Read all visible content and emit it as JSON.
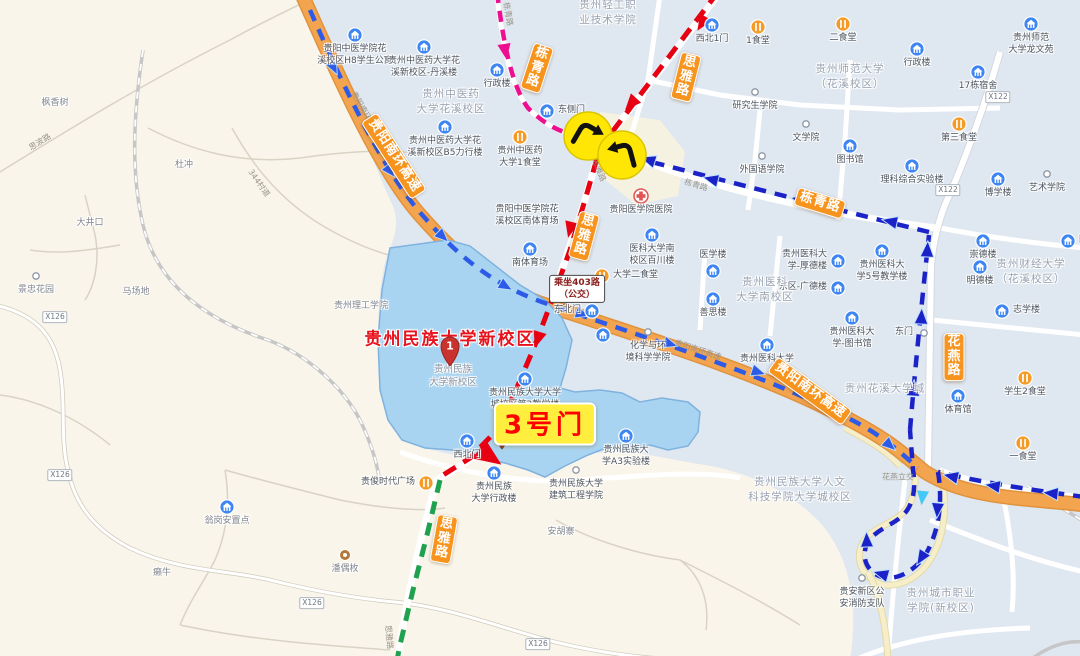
{
  "map": {
    "destination": {
      "name": "贵州民族大学新校区",
      "pin_number": "1",
      "sub_lines": [
        "贵州民族",
        "大学新校区"
      ]
    },
    "gate_callout": "3号门",
    "bus_callout_lines": [
      "乘坐403路",
      "（公交）"
    ],
    "colors": {
      "highway": "#F3A44F",
      "route_red": "#E60012",
      "route_pink": "#ED0F8F",
      "route_blue": "#1B23C8",
      "route_blue_light": "#2D5BE8",
      "route_cyan": "#45C8F5",
      "route_green": "#1FA14F",
      "campus_fill": "#A9D4F1",
      "campus_stroke": "#7FB2DE",
      "urban_fill": "#DFE7F0",
      "rural_fill": "#F9F5EA",
      "ribbon_bg": "#F7941E",
      "turn_icon_bg": "#FFE604"
    }
  },
  "road_ribbons": [
    {
      "n": "ribbon-nanhuan-west",
      "t": "贵阳南环高速",
      "x": 394,
      "y": 156,
      "r": 57,
      "stacked": false
    },
    {
      "n": "ribbon-nanhuan-east",
      "t": "贵阳南环高速",
      "x": 810,
      "y": 391,
      "r": 36,
      "stacked": false
    },
    {
      "n": "ribbon-dongqing-east",
      "t": "栋青路",
      "x": 820,
      "y": 203,
      "r": 17,
      "stacked": false
    },
    {
      "n": "ribbon-dongqing-north",
      "t": "栋青路",
      "x": 537,
      "y": 68,
      "r": 18,
      "stacked": true
    },
    {
      "n": "ribbon-siya-north",
      "t": "思雅路",
      "x": 686,
      "y": 77,
      "r": 14,
      "stacked": true
    },
    {
      "n": "ribbon-siya-mid",
      "t": "思雅路",
      "x": 584,
      "y": 236,
      "r": 15,
      "stacked": true
    },
    {
      "n": "ribbon-siya-south",
      "t": "思雅路",
      "x": 444,
      "y": 539,
      "r": 10,
      "stacked": true
    },
    {
      "n": "ribbon-huayan",
      "t": "花燕路",
      "x": 954,
      "y": 357,
      "r": 0,
      "stacked": true
    }
  ],
  "area_labels": [
    {
      "n": "area-zhongyiyao-campus",
      "x": 451,
      "y": 102,
      "l": [
        "贵州中医药",
        "大学花溪校区"
      ]
    },
    {
      "n": "area-shifan-campus",
      "x": 850,
      "y": 77,
      "l": [
        "贵州师范大学",
        "（花溪校区）"
      ]
    },
    {
      "n": "area-qinggong-college",
      "x": 608,
      "y": 13,
      "l": [
        "贵州轻工职",
        "业技术学院"
      ]
    },
    {
      "n": "area-caijing-campus",
      "x": 1031,
      "y": 272,
      "l": [
        "贵州财经大学",
        "（花溪校区）"
      ]
    },
    {
      "n": "area-yike-south-campus",
      "x": 765,
      "y": 290,
      "l": [
        "贵州医科",
        "大学南校区"
      ]
    },
    {
      "n": "area-huaxi-university-town",
      "x": 885,
      "y": 389,
      "l": [
        "贵州花溪大学城"
      ]
    },
    {
      "n": "area-renwen-keji-campus",
      "x": 800,
      "y": 490,
      "l": [
        "贵州民族大学人文",
        "科技学院大学城校区"
      ]
    },
    {
      "n": "area-city-vocational",
      "x": 941,
      "y": 601,
      "l": [
        "贵州城市职业",
        "学院(新校区)"
      ]
    }
  ],
  "pois": [
    {
      "n": "poi-h8-dorm",
      "i": "b",
      "x": 355,
      "y": 35,
      "l": [
        "贵阳中医学院花",
        "溪校区H8学生公寓"
      ],
      "p": "pb"
    },
    {
      "n": "poi-danxi-building",
      "i": "b",
      "x": 424,
      "y": 47,
      "l": [
        "贵州中医药大学花",
        "溪新校区-丹溪楼"
      ],
      "p": "pb"
    },
    {
      "n": "poi-zy-admin",
      "i": "b",
      "x": 497,
      "y": 70,
      "l": [
        "行政楼"
      ],
      "p": "pb"
    },
    {
      "n": "poi-b5-building",
      "i": "b",
      "x": 445,
      "y": 127,
      "l": [
        "贵州中医药大学花",
        "溪新校区B5力行楼"
      ],
      "p": "pb"
    },
    {
      "n": "poi-zy-canteen1",
      "i": "f",
      "x": 520,
      "y": 137,
      "l": [
        "贵州中医药",
        "大学1食堂"
      ],
      "p": "pb"
    },
    {
      "n": "poi-east-side-gate",
      "i": "b",
      "x": 547,
      "y": 111,
      "l": [
        "东侧门"
      ],
      "p": "pr"
    },
    {
      "n": "poi-northwest-gate1",
      "i": "b",
      "x": 712,
      "y": 25,
      "l": [
        "西北1门"
      ],
      "p": "pb"
    },
    {
      "n": "poi-canteen1",
      "i": "f",
      "x": 758,
      "y": 27,
      "l": [
        "1食堂"
      ],
      "p": "pb"
    },
    {
      "n": "poi-canteen2",
      "i": "f",
      "x": 843,
      "y": 24,
      "l": [
        "二食堂"
      ],
      "p": "pb"
    },
    {
      "n": "poi-shida-admin",
      "i": "b",
      "x": 917,
      "y": 49,
      "l": [
        "行政楼"
      ],
      "p": "pb"
    },
    {
      "n": "poi-graduate-school",
      "i": "d",
      "x": 755,
      "y": 92,
      "l": [
        "研究生学院"
      ],
      "p": "pb"
    },
    {
      "n": "poi-wenxueyuan",
      "i": "d",
      "x": 806,
      "y": 124,
      "l": [
        "文学院"
      ],
      "p": "pb"
    },
    {
      "n": "poi-shida-library",
      "i": "b",
      "x": 850,
      "y": 146,
      "l": [
        "图书馆"
      ],
      "p": "pb"
    },
    {
      "n": "poi-foreign-languages",
      "i": "d",
      "x": 762,
      "y": 156,
      "l": [
        "外国语学院"
      ],
      "p": "pb"
    },
    {
      "n": "poi-science-lab",
      "i": "b",
      "x": 912,
      "y": 166,
      "l": [
        "理科综合实验楼"
      ],
      "p": "pb"
    },
    {
      "n": "poi-dorm-17",
      "i": "b",
      "x": 978,
      "y": 72,
      "l": [
        "17栋宿舍"
      ],
      "p": "pb"
    },
    {
      "n": "poi-longwenyuan",
      "i": "b",
      "x": 1031,
      "y": 24,
      "l": [
        "贵州师范",
        "大学龙文苑"
      ],
      "p": "pb"
    },
    {
      "n": "poi-canteen3",
      "i": "f",
      "x": 959,
      "y": 124,
      "l": [
        "第三食堂"
      ],
      "p": "pb"
    },
    {
      "n": "poi-art-school",
      "i": "d",
      "x": 1047,
      "y": 174,
      "l": [
        "艺术学院"
      ],
      "p": "pb"
    },
    {
      "n": "poi-boxuelou",
      "i": "b",
      "x": 998,
      "y": 179,
      "l": [
        "博学楼"
      ],
      "p": "pb"
    },
    {
      "n": "poi-chongdelou",
      "i": "b",
      "x": 983,
      "y": 241,
      "l": [
        "崇德楼"
      ],
      "p": "pb"
    },
    {
      "n": "poi-yike-building5",
      "i": "b",
      "x": 882,
      "y": 251,
      "l": [
        "贵州医科大",
        "学5号教学楼"
      ],
      "p": "pb"
    },
    {
      "n": "poi-mingdelou",
      "i": "b",
      "x": 980,
      "y": 267,
      "l": [
        "明德楼"
      ],
      "p": "pb"
    },
    {
      "n": "poi-zhixuelou",
      "i": "b",
      "x": 1002,
      "y": 311,
      "l": [
        "志学楼"
      ],
      "p": "pr"
    },
    {
      "n": "poi-caijing-library",
      "i": "b",
      "x": 1068,
      "y": 241,
      "l": [
        "图书馆"
      ],
      "p": "pr"
    },
    {
      "n": "poi-east-gate",
      "i": "d",
      "x": 924,
      "y": 333,
      "l": [
        "东门"
      ],
      "p": "pl"
    },
    {
      "n": "poi-yixuelou",
      "i": "b",
      "x": 713,
      "y": 271,
      "l": [
        "医学楼"
      ],
      "p": "pa"
    },
    {
      "n": "poi-houdelou",
      "i": "b",
      "x": 838,
      "y": 261,
      "l": [
        "贵州医科大",
        "学-厚德楼"
      ],
      "p": "pl"
    },
    {
      "n": "poi-guangdelou",
      "i": "b",
      "x": 838,
      "y": 288,
      "l": [
        "东区-广德楼"
      ],
      "p": "pl"
    },
    {
      "n": "poi-shansilou",
      "i": "b",
      "x": 713,
      "y": 299,
      "l": [
        "善思楼"
      ],
      "p": "pb"
    },
    {
      "n": "poi-yike-library",
      "i": "b",
      "x": 852,
      "y": 318,
      "l": [
        "贵州医科大",
        "学-图书馆"
      ],
      "p": "pb"
    },
    {
      "n": "poi-yike-university",
      "i": "b",
      "x": 767,
      "y": 345,
      "l": [
        "贵州医科大学"
      ],
      "p": "pb"
    },
    {
      "n": "poi-guiyang-hospital",
      "i": "h",
      "x": 641,
      "y": 196,
      "l": [
        "贵阳医学院医院"
      ],
      "p": "pb"
    },
    {
      "n": "poi-baichuanlou",
      "i": "b",
      "x": 652,
      "y": 235,
      "l": [
        "医科大学南",
        "校区百川楼"
      ],
      "p": "pb"
    },
    {
      "n": "poi-univ-canteen2",
      "i": "f",
      "x": 602,
      "y": 276,
      "l": [
        "大学二食堂"
      ],
      "p": "pr"
    },
    {
      "n": "poi-south-stadium-name",
      "i": "n",
      "x": 527,
      "y": 216,
      "l": [
        "贵阳中医学院花",
        "溪校区南体育场"
      ],
      "p": "pc"
    },
    {
      "n": "poi-south-stadium",
      "i": "b",
      "x": 530,
      "y": 249,
      "l": [
        "南体育场"
      ],
      "p": "pb"
    },
    {
      "n": "poi-northeast-gate",
      "i": "b",
      "x": 592,
      "y": 311,
      "l": [
        "东北门"
      ],
      "p": "pl"
    },
    {
      "n": "poi-northeast-gate-stop",
      "i": "b",
      "x": 603,
      "y": 335,
      "l": [],
      "p": "pb"
    },
    {
      "n": "poi-chemistry-school",
      "i": "d",
      "x": 648,
      "y": 332,
      "l": [
        "化学与环",
        "境科学学院"
      ],
      "p": "pb"
    },
    {
      "n": "poi-teaching-building2",
      "i": "b",
      "x": 525,
      "y": 379,
      "l": [
        "贵州民族大学大学",
        "城校区第2教学楼"
      ],
      "p": "pb"
    },
    {
      "n": "poi-northwest-gate",
      "i": "b",
      "x": 467,
      "y": 441,
      "l": [
        "西北门"
      ],
      "p": "pb"
    },
    {
      "n": "poi-media-school",
      "i": "p",
      "x": 502,
      "y": 441,
      "l": [
        "传媒学院"
      ],
      "p": "pr"
    },
    {
      "n": "poi-a3-lab",
      "i": "b",
      "x": 626,
      "y": 436,
      "l": [
        "贵州民族大",
        "学A3实验楼"
      ],
      "p": "pb"
    },
    {
      "n": "poi-minzu-admin",
      "i": "b",
      "x": 494,
      "y": 473,
      "l": [
        "贵州民族",
        "大学行政楼"
      ],
      "p": "pb"
    },
    {
      "n": "poi-architecture-school",
      "i": "d",
      "x": 576,
      "y": 470,
      "l": [
        "贵州民族大学",
        "建筑工程学院"
      ],
      "p": "pb"
    },
    {
      "n": "poi-guijun-plaza",
      "i": "f",
      "x": 426,
      "y": 483,
      "l": [
        "贵俊时代广场"
      ],
      "p": "pl"
    },
    {
      "n": "poi-guizhou-tech",
      "i": "n",
      "x": 361,
      "y": 307,
      "l": [
        "贵州理工学院"
      ],
      "p": "pc",
      "rural": true
    },
    {
      "n": "poi-wenggang-settlement",
      "i": "b",
      "x": 227,
      "y": 507,
      "l": [
        "翁岗安置点"
      ],
      "p": "pb",
      "rural": true
    },
    {
      "n": "poi-panoumei",
      "i": "t",
      "x": 345,
      "y": 555,
      "l": [
        "潘偶枚"
      ],
      "p": "pb",
      "rural": true
    },
    {
      "n": "poi-lainiu",
      "i": "n",
      "x": 162,
      "y": 574,
      "l": [
        "癞牛"
      ],
      "p": "pc",
      "rural": true
    },
    {
      "n": "poi-anhuzhai",
      "i": "n",
      "x": 561,
      "y": 533,
      "l": [
        "安胡寨"
      ],
      "p": "pc",
      "rural": true
    },
    {
      "n": "poi-gymnasium",
      "i": "b",
      "x": 958,
      "y": 396,
      "l": [
        "体育馆"
      ],
      "p": "pb"
    },
    {
      "n": "poi-student-canteen2",
      "i": "f",
      "x": 1025,
      "y": 378,
      "l": [
        "学生2食堂"
      ],
      "p": "pb"
    },
    {
      "n": "poi-yishitang",
      "i": "f",
      "x": 1023,
      "y": 443,
      "l": [
        "一食堂"
      ],
      "p": "pb"
    },
    {
      "n": "poi-fire-brigade",
      "i": "d",
      "x": 862,
      "y": 578,
      "l": [
        "贵安新区公",
        "安消防支队"
      ],
      "p": "pb"
    },
    {
      "n": "poi-fengxiangshu",
      "i": "n",
      "x": 55,
      "y": 104,
      "l": [
        "枫香树"
      ],
      "p": "pc",
      "rural": true
    },
    {
      "n": "poi-duchong",
      "i": "n",
      "x": 184,
      "y": 166,
      "l": [
        "杜冲"
      ],
      "p": "pc",
      "rural": true
    },
    {
      "n": "poi-dajingkou",
      "i": "n",
      "x": 90,
      "y": 224,
      "l": [
        "大井口"
      ],
      "p": "pc",
      "rural": true
    },
    {
      "n": "poi-jingzhong-garden",
      "i": "d",
      "x": 36,
      "y": 276,
      "l": [
        "景忠花园"
      ],
      "p": "pb",
      "rural": true
    },
    {
      "n": "poi-machangdi",
      "i": "n",
      "x": 136,
      "y": 293,
      "l": [
        "马场地"
      ],
      "p": "pc",
      "rural": true
    }
  ],
  "road_shields": [
    {
      "n": "shield-x122-north",
      "t": "X122",
      "x": 998,
      "y": 97
    },
    {
      "n": "shield-x122-south",
      "t": "X122",
      "x": 948,
      "y": 190
    },
    {
      "n": "shield-x126-a",
      "t": "X126",
      "x": 55,
      "y": 317
    },
    {
      "n": "shield-x126-b",
      "t": "X126",
      "x": 60,
      "y": 475
    },
    {
      "n": "shield-x126-c",
      "t": "X126",
      "x": 312,
      "y": 603
    },
    {
      "n": "shield-x126-d",
      "t": "X126",
      "x": 538,
      "y": 644
    }
  ],
  "tiny_road_labels": [
    {
      "n": "road-sibolu",
      "t": "思波路",
      "x": 40,
      "y": 142,
      "r": -32
    },
    {
      "n": "road-344-village",
      "t": "344村道",
      "x": 259,
      "y": 183,
      "r": 55
    },
    {
      "n": "road-dongqinglu-small-n",
      "t": "栋青路",
      "x": 508,
      "y": 14,
      "r": 80
    },
    {
      "n": "road-siyalu-small-n",
      "t": "思雅路",
      "x": 599,
      "y": 170,
      "r": 68
    },
    {
      "n": "road-dongqinglu-small-e",
      "t": "栋青路",
      "x": 696,
      "y": 185,
      "r": 17
    },
    {
      "n": "road-nanhuan-small-w",
      "t": "贵阳南环高速",
      "x": 365,
      "y": 113,
      "r": 60
    },
    {
      "n": "road-nanhuan-small-e",
      "t": "贵阳南环高速",
      "x": 698,
      "y": 350,
      "r": 18
    },
    {
      "n": "road-siyalu-small-s",
      "t": "思雅路",
      "x": 389,
      "y": 637,
      "r": 85
    },
    {
      "n": "road-huayan-interchange",
      "t": "花燕立交",
      "x": 898,
      "y": 477,
      "r": 0
    }
  ],
  "turn_icons": [
    {
      "n": "turn-right-icon",
      "type": "turn-right",
      "x": 588,
      "y": 136
    },
    {
      "n": "turn-left-icon",
      "type": "turn-left",
      "x": 622,
      "y": 155
    }
  ]
}
